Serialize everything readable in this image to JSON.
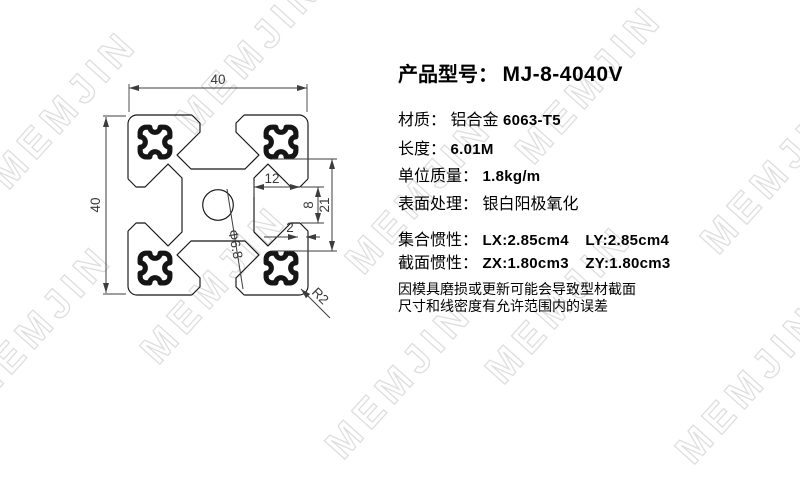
{
  "watermark": {
    "text": "MEMJIN",
    "color": "#dedede"
  },
  "drawing": {
    "labels": {
      "width": "40",
      "height": "40",
      "slot_depth": "12",
      "slot_opening": "8",
      "slot_inner_width": "21",
      "lip_thickness": "2",
      "center_hole_dia": "Φ6.8",
      "corner_radius": "R2"
    }
  },
  "specs": {
    "title_label": "产品型号：",
    "model": "MJ-8-4040V",
    "rows": [
      {
        "label": "材质：",
        "value_cn": "铝合金",
        "value": "6063-T5"
      },
      {
        "label": "长度：",
        "value": "6.01M"
      },
      {
        "label": "单位质量：",
        "value": "1.8kg/m"
      },
      {
        "label": "表面处理：",
        "value_cn": "银白阳极氧化"
      }
    ],
    "inertia": [
      {
        "label": "集合惯性：",
        "v1": "LX:2.85cm4",
        "v2": "LY:2.85cm4"
      },
      {
        "label": "截面惯性：",
        "v1": "ZX:1.80cm3",
        "v2": "ZY:1.80cm3"
      }
    ],
    "note_line1": "因模具磨损或更新可能会导致型材截面",
    "note_line2": "尺寸和线密度有允许范围内的误差"
  }
}
